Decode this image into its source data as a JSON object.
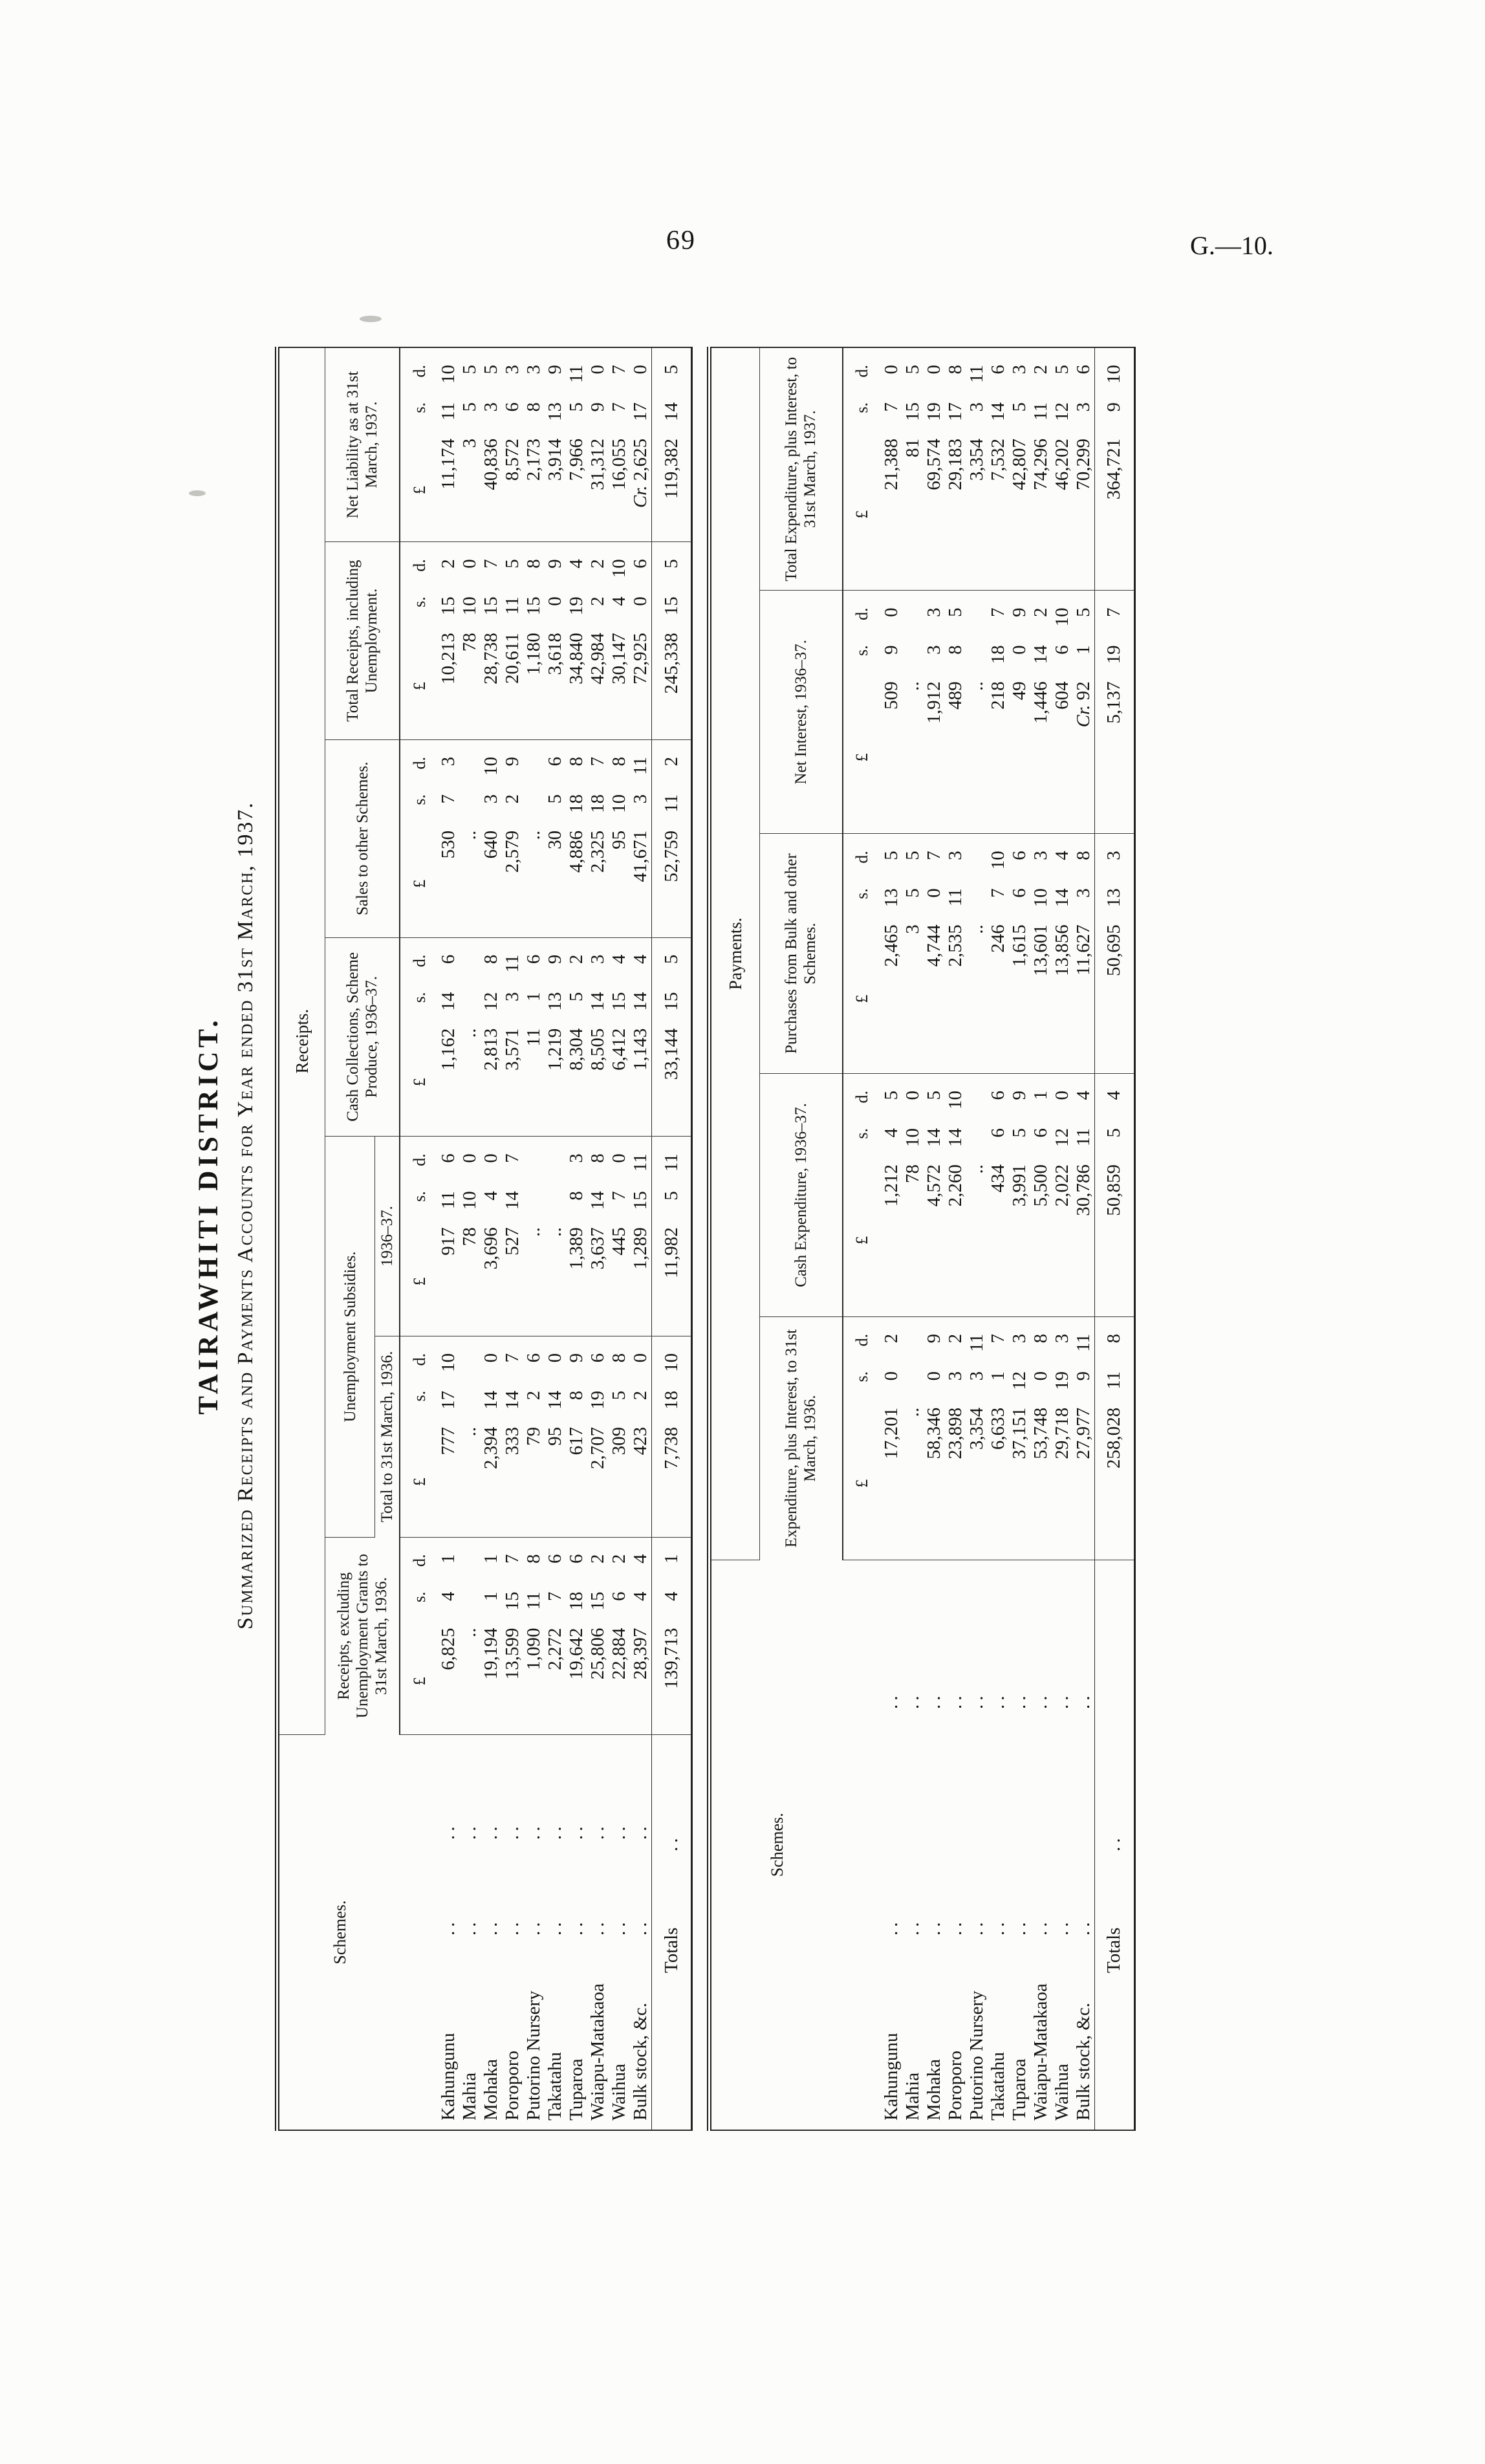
{
  "page": {
    "number": "69",
    "doc_ref": "G.—10."
  },
  "heading": {
    "district": "TAIRAWHITI DISTRICT.",
    "subtitle": "Summarized Receipts and Payments Accounts for Year ended 31st March, 1937."
  },
  "leader_dots": "..",
  "money_unit": {
    "pounds": "£",
    "shillings": "s.",
    "pence": "d."
  },
  "receipts_table": {
    "section_label": "Receipts.",
    "schemes_header": "Schemes.",
    "group_header": "Unemployment Subsidies.",
    "columns": [
      {
        "label": "Receipts, excluding Unemployment Grants to 31st March, 1936."
      },
      {
        "label": "Total to 31st March, 1936."
      },
      {
        "label": "1936–37."
      },
      {
        "label": "Cash Collections, Scheme Produce, 1936–37."
      },
      {
        "label": "Sales to other Schemes."
      },
      {
        "label": "Total Receipts, including Unemployment."
      },
      {
        "label": "Net Liability as at 31st March, 1937."
      }
    ],
    "rows": [
      {
        "scheme": "Kahungunu",
        "values": [
          "6,825 4 1",
          "777 17 10",
          "917 11 6",
          "1,162 14 6",
          "530 7 3",
          "10,213 15 2",
          "11,174 11 10"
        ]
      },
      {
        "scheme": "Mahia",
        "values": [
          "..",
          "..",
          "78 10 0",
          "..",
          "..",
          "78 10 0",
          "3 5 5"
        ]
      },
      {
        "scheme": "Mohaka",
        "values": [
          "19,194 1 1",
          "2,394 14 0",
          "3,696 4 0",
          "2,813 12 8",
          "640 3 10",
          "28,738 15 7",
          "40,836 3 5"
        ]
      },
      {
        "scheme": "Poroporo",
        "values": [
          "13,599 15 7",
          "333 14 7",
          "527 14 7",
          "3,571 3 11",
          "2,579 2 9",
          "20,611 11 5",
          "8,572 6 3"
        ]
      },
      {
        "scheme": "Putorino Nursery",
        "values": [
          "1,090 11 8",
          "79 2 6",
          "..",
          "11 1 6",
          "..",
          "1,180 15 8",
          "2,173 8 3"
        ]
      },
      {
        "scheme": "Takatahu",
        "values": [
          "2,272 7 6",
          "95 14 0",
          "..",
          "1,219 13 9",
          "30 5 6",
          "3,618 0 9",
          "3,914 13 9"
        ]
      },
      {
        "scheme": "Tuparoa",
        "values": [
          "19,642 18 6",
          "617 8 9",
          "1,389 8 3",
          "8,304 5 2",
          "4,886 18 8",
          "34,840 19 4",
          "7,966 5 11"
        ]
      },
      {
        "scheme": "Waiapu-Matakaoa",
        "values": [
          "25,806 15 2",
          "2,707 19 6",
          "3,637 14 8",
          "8,505 14 3",
          "2,325 18 7",
          "42,984 2 2",
          "31,312 9 0"
        ]
      },
      {
        "scheme": "Waihua",
        "values": [
          "22,884 6 2",
          "309 5 8",
          "445 7 0",
          "6,412 15 4",
          "95 10 8",
          "30,147 4 10",
          "16,055 7 7"
        ]
      },
      {
        "scheme": "Bulk stock, &c.",
        "values": [
          "28,397 4 4",
          "423 2 0",
          "1,289 15 11",
          "1,143 14 4",
          "41,671 3 11",
          "72,925 0 6",
          "Cr. 2,625 17 0"
        ]
      }
    ],
    "totals_label": "Totals",
    "totals": [
      "139,713 4 1",
      "7,738 18 10",
      "11,982 5 11",
      "33,144 15 5",
      "52,759 11 2",
      "245,338 15 5",
      "119,382 14 5"
    ]
  },
  "payments_table": {
    "section_label": "Payments.",
    "schemes_header": "Schemes.",
    "columns": [
      {
        "label": "Expenditure, plus Interest, to 31st March, 1936."
      },
      {
        "label": "Cash Expenditure, 1936–37."
      },
      {
        "label": "Purchases from Bulk and other Schemes."
      },
      {
        "label": "Net Interest, 1936–37."
      },
      {
        "label": "Total Expenditure, plus Interest, to 31st March, 1937."
      }
    ],
    "rows": [
      {
        "scheme": "Kahungunu",
        "values": [
          "17,201 0 2",
          "1,212 4 5",
          "2,465 13 5",
          "509 9 0",
          "21,388 7 0"
        ]
      },
      {
        "scheme": "Mahia",
        "values": [
          "..",
          "78 10 0",
          "3 5 5",
          "..",
          "81 15 5"
        ]
      },
      {
        "scheme": "Mohaka",
        "values": [
          "58,346 0 9",
          "4,572 14 5",
          "4,744 0 7",
          "1,912 3 3",
          "69,574 19 0"
        ]
      },
      {
        "scheme": "Poroporo",
        "values": [
          "23,898 3 2",
          "2,260 14 10",
          "2,535 11 3",
          "489 8 5",
          "29,183 17 8"
        ]
      },
      {
        "scheme": "Putorino Nursery",
        "values": [
          "3,354 3 11",
          "..",
          "..",
          "..",
          "3,354 3 11"
        ]
      },
      {
        "scheme": "Takatahu",
        "values": [
          "6,633 1 7",
          "434 6 6",
          "246 7 10",
          "218 18 7",
          "7,532 14 6"
        ]
      },
      {
        "scheme": "Tuparoa",
        "values": [
          "37,151 12 3",
          "3,991 5 9",
          "1,615 6 6",
          "49 0 9",
          "42,807 5 3"
        ]
      },
      {
        "scheme": "Waiapu-Matakaoa",
        "values": [
          "53,748 0 8",
          "5,500 6 1",
          "13,601 10 3",
          "1,446 14 2",
          "74,296 11 2"
        ]
      },
      {
        "scheme": "Waihua",
        "values": [
          "29,718 19 3",
          "2,022 12 0",
          "13,856 14 4",
          "604 6 10",
          "46,202 12 5"
        ]
      },
      {
        "scheme": "Bulk stock, &c.",
        "values": [
          "27,977 9 11",
          "30,786 11 4",
          "11,627 3 8",
          "Cr. 92 1 5",
          "70,299 3 6"
        ]
      }
    ],
    "totals_label": "Totals",
    "totals": [
      "258,028 11 8",
      "50,859 5 4",
      "50,695 13 3",
      "5,137 19 7",
      "364,721 9 10"
    ]
  }
}
